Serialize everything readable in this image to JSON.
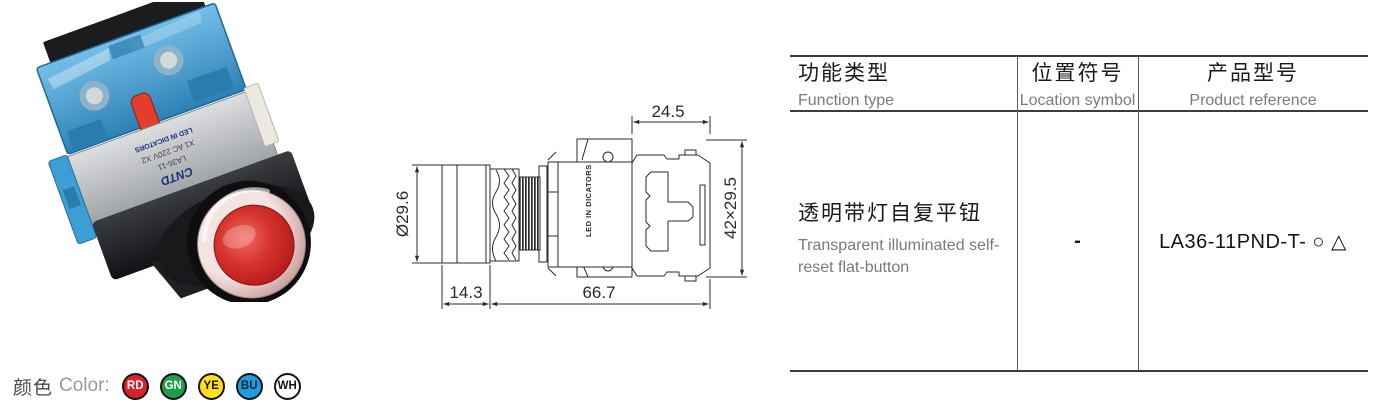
{
  "product_photo": {
    "description": "Angled photo of red transparent illuminated flat push-button switch with blue contact block",
    "markings": {
      "brand": "CNTD",
      "model": "LA36-11",
      "terminals": "X1  AC 220V  X2",
      "led": "LED IN DICATORS"
    },
    "button_color": "#c5212b",
    "contact_block_color": "#4aa5d8"
  },
  "dimension_drawing": {
    "dimensions": {
      "contact_block_width": "24.5",
      "head_diameter": "Ø29.6",
      "block_face": "42×29.5",
      "head_depth": "14.3",
      "body_length": "66.7"
    },
    "led_label": "LED IN DICATORS",
    "led_label_color": "#2438c8"
  },
  "spec_table": {
    "columns": [
      {
        "zh": "功能类型",
        "en": "Function type"
      },
      {
        "zh": "位置符号",
        "en": "Location symbol"
      },
      {
        "zh": "产品型号",
        "en": "Product reference"
      }
    ],
    "row": {
      "function_zh": "透明带灯自复平钮",
      "function_en": "Transparent illuminated self-reset flat-button",
      "location_symbol": "-",
      "product_reference": "LA36-11PND-T- ○ △"
    }
  },
  "color_legend": {
    "label_zh": "颜色",
    "label_en": "Color:",
    "options": [
      {
        "code": "RD",
        "fill": "#d8232a",
        "text_color": "#ffffff"
      },
      {
        "code": "GN",
        "fill": "#1e9e4a",
        "text_color": "#ffffff"
      },
      {
        "code": "YE",
        "fill": "#ffe01a",
        "text_color": "#141414"
      },
      {
        "code": "BU",
        "fill": "#1d9ce0",
        "text_color": "#10243a"
      },
      {
        "code": "WH",
        "fill": "#ffffff",
        "text_color": "#141414"
      }
    ]
  }
}
